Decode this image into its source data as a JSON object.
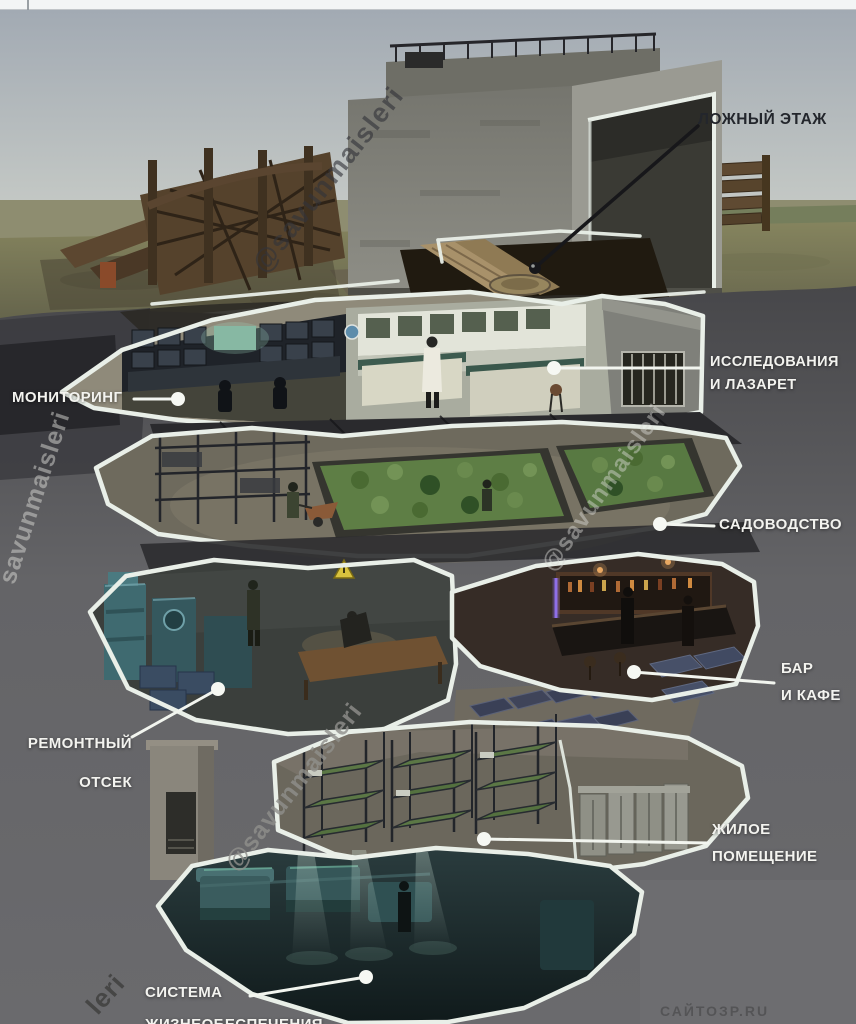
{
  "callouts": {
    "false_floor": {
      "text": "ЛОЖНЫЙ ЭТАЖ"
    },
    "research_infirmary": {
      "line1": "ИССЛЕДОВАНИЯ",
      "line2": "И ЛАЗАРЕТ"
    },
    "monitoring": {
      "text": "МОНИТОРИНГ"
    },
    "gardening": {
      "text": "САДОВОДСТВО"
    },
    "bar_cafe": {
      "line1": "БАР",
      "line2": "И КАФЕ"
    },
    "repair_bay": {
      "line1": "РЕМОНТНЫЙ",
      "line2": "ОТСЕК"
    },
    "living_quarters": {
      "line1": "ЖИЛОЕ",
      "line2": "ПОМЕЩЕНИЕ"
    },
    "life_support": {
      "line1": "СИСТЕМА",
      "line2_partial": "ЖИЗНЕОБЕСПЕЧЕНИЯ"
    }
  },
  "watermarks": {
    "handle_full": "@savunmaisleri",
    "handle_plain": "savunmaisleri",
    "fragment": "leri",
    "corner_faint": "САЙТОЗР.RU"
  },
  "colors": {
    "outline_white": "#e9efe8",
    "label_white": "#f3f3ef",
    "label_dark": "#23262c",
    "leader_black": "#17171a",
    "soil_gray": "#626266",
    "sky_gray_blue": "#a9b0b7",
    "grass_olive": "#7c7b57",
    "garden_green": "#5e7e45",
    "machine_teal": "#3f6a70",
    "mat_blue": "#454c66",
    "bunk_green": "#5b7745",
    "bar_glow": "#82502c"
  }
}
